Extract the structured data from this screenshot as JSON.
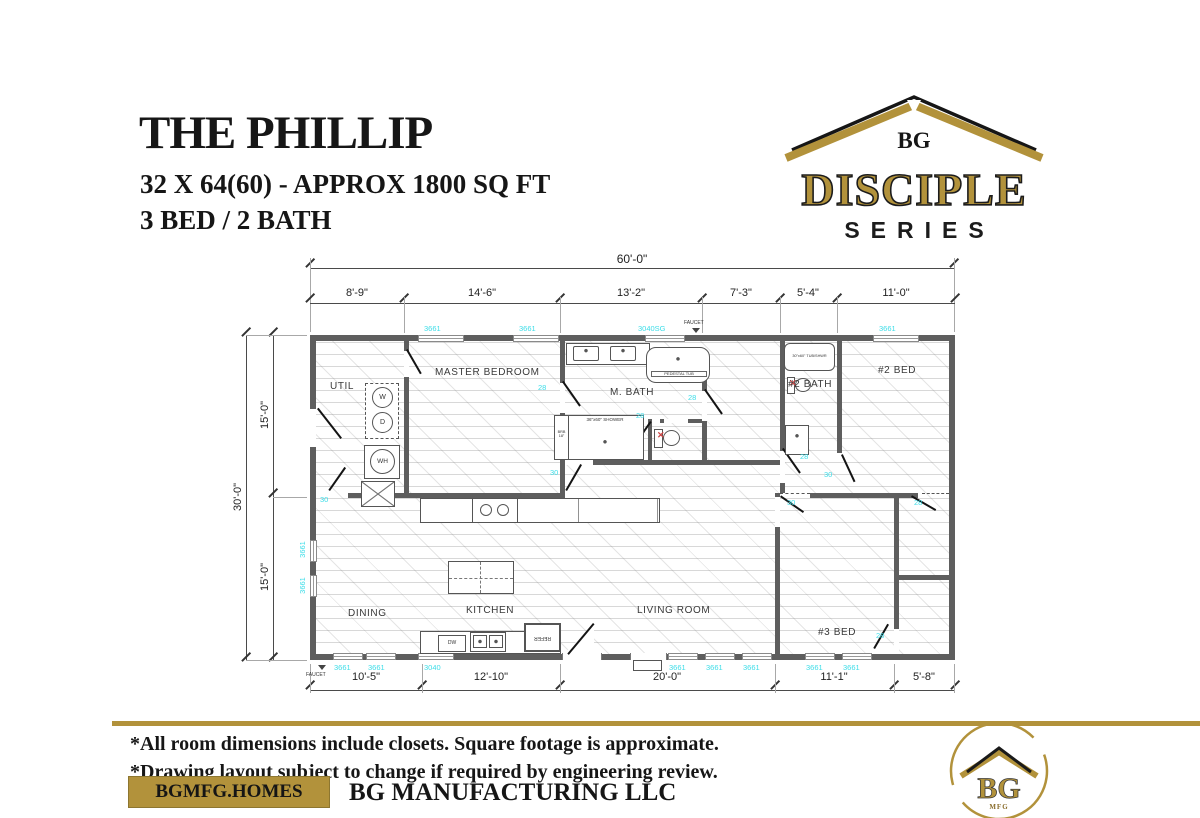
{
  "header": {
    "title": "THE PHILLIP",
    "subtitle": "32 X 64(60) - APPROX 1800 SQ FT",
    "beds_baths": "3 BED / 2 BATH"
  },
  "series_logo": {
    "brand": "BG",
    "name": "DISCIPLE",
    "word": "SERIES"
  },
  "colors": {
    "gold": "#B2923B",
    "cyan": "#3DDDE8",
    "wall_gray": "#5E5E5E",
    "ink": "#161616"
  },
  "plan": {
    "overall_width": "60'-0\"",
    "overall_depth": "30'-0\"",
    "top_segments": [
      "8'-9\"",
      "14'-6\"",
      "13'-2\"",
      "7'-3\"",
      "5'-4\"",
      "11'-0\""
    ],
    "left_segments": [
      "15'-0\"",
      "15'-0\""
    ],
    "bottom_segments": [
      "10'-5\"",
      "12'-10\"",
      "20'-0\"",
      "11'-1\"",
      "5'-8\""
    ],
    "rooms": {
      "util": "UTIL",
      "master": "MASTER BEDROOM",
      "mbath": "M. BATH",
      "bath2": "#2 BATH",
      "bed2": "#2 BED",
      "dining": "DINING",
      "kitchen": "KITCHEN",
      "living": "LIVING ROOM",
      "bed3": "#3 BED"
    },
    "tags": {
      "w3661": "3661",
      "w3040": "3040",
      "w3040sg": "3040SG",
      "d28": "28",
      "d30": "30",
      "faucet": "FAUCET"
    },
    "fixtures": {
      "washer": "W",
      "dryer": "D",
      "water_heater": "WH",
      "pedestal_tub": "PEDESTAL TUB",
      "shower": "36\"x60\" SHOWER",
      "brb": "BRB\n18\"",
      "tub_shwr": "30\"x60\" TUB/SHWR",
      "dw": "DW",
      "refer": "REFER"
    }
  },
  "footer": {
    "note1": "*All room dimensions include closets. Square footage is approximate.",
    "note2": "*Drawing layout subject to change if required by engineering review.",
    "website": "BGMFG.HOMES",
    "company": "BG MANUFACTURING LLC",
    "badge_brand": "BG",
    "badge_sub": "MFG"
  }
}
